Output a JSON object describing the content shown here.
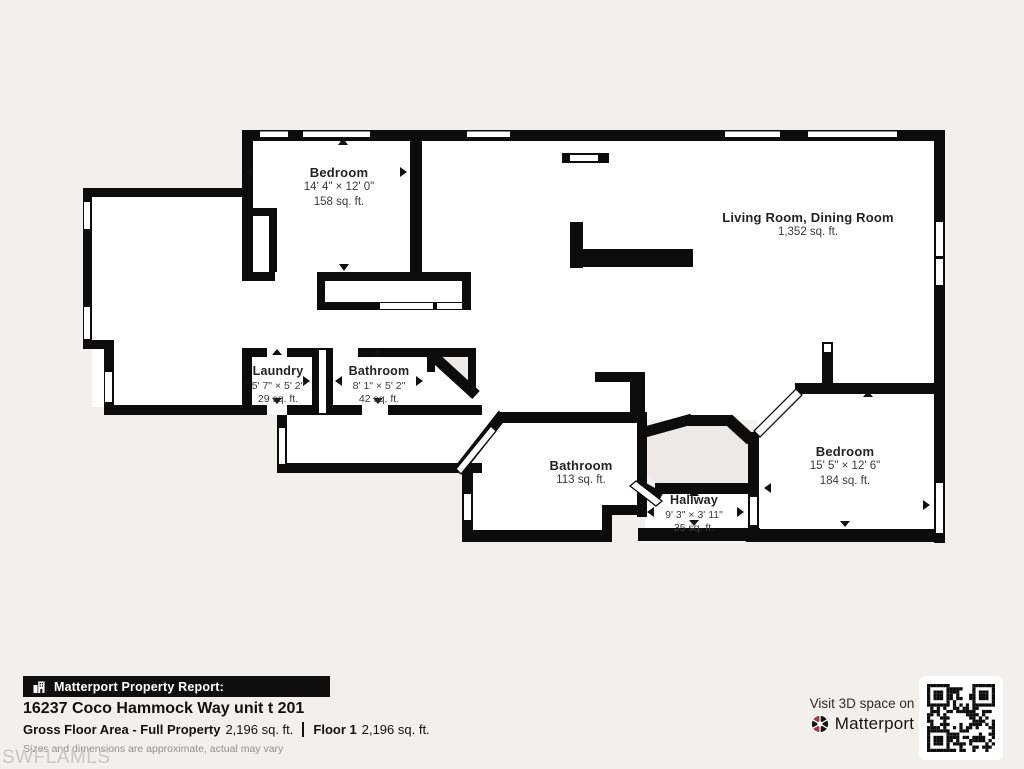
{
  "page": {
    "watermark": "SWFLAMLS"
  },
  "colors": {
    "background": "#f1f0ee",
    "wall": "#0c0c0c",
    "room_fill": "#ffffff",
    "pocket_fill": "#ebeae8",
    "brand_red": "#a03a4d",
    "watermark_gray": "#c9c8c6"
  },
  "floorplan": {
    "rooms": [
      {
        "id": "bedroom-1",
        "name": "Bedroom",
        "dimensions": "14' 4\" × 12' 0\"",
        "area": "158 sq. ft."
      },
      {
        "id": "living-dining",
        "name": "Living Room, Dining Room",
        "area": "1,352 sq. ft."
      },
      {
        "id": "laundry",
        "name": "Laundry",
        "dimensions": "5' 7\" × 5' 2\"",
        "area": "29 sq. ft."
      },
      {
        "id": "bathroom-small",
        "name": "Bathroom",
        "dimensions": "8' 1\" × 5' 2\"",
        "area": "42 sq. ft."
      },
      {
        "id": "bathroom-large",
        "name": "Bathroom",
        "area": "113 sq. ft."
      },
      {
        "id": "hallway",
        "name": "Hallway",
        "dimensions": "9' 3\" × 3' 11\"",
        "area": "35 sq. ft."
      },
      {
        "id": "bedroom-2",
        "name": "Bedroom",
        "dimensions": "15' 5\" × 12' 6\"",
        "area": "184 sq. ft."
      }
    ]
  },
  "footer": {
    "report_label": "Matterport Property Report:",
    "address": "16237 Coco Hammock Way unit t 201",
    "gross_label": "Gross Floor Area - Full Property",
    "gross_value": "2,196 sq. ft.",
    "floor_label": "Floor 1",
    "floor_value": "2,196 sq. ft.",
    "disclaimer": "Sizes and dimensions are approximate, actual may vary",
    "visit_text": "Visit 3D space on",
    "brand": "Matterport"
  }
}
